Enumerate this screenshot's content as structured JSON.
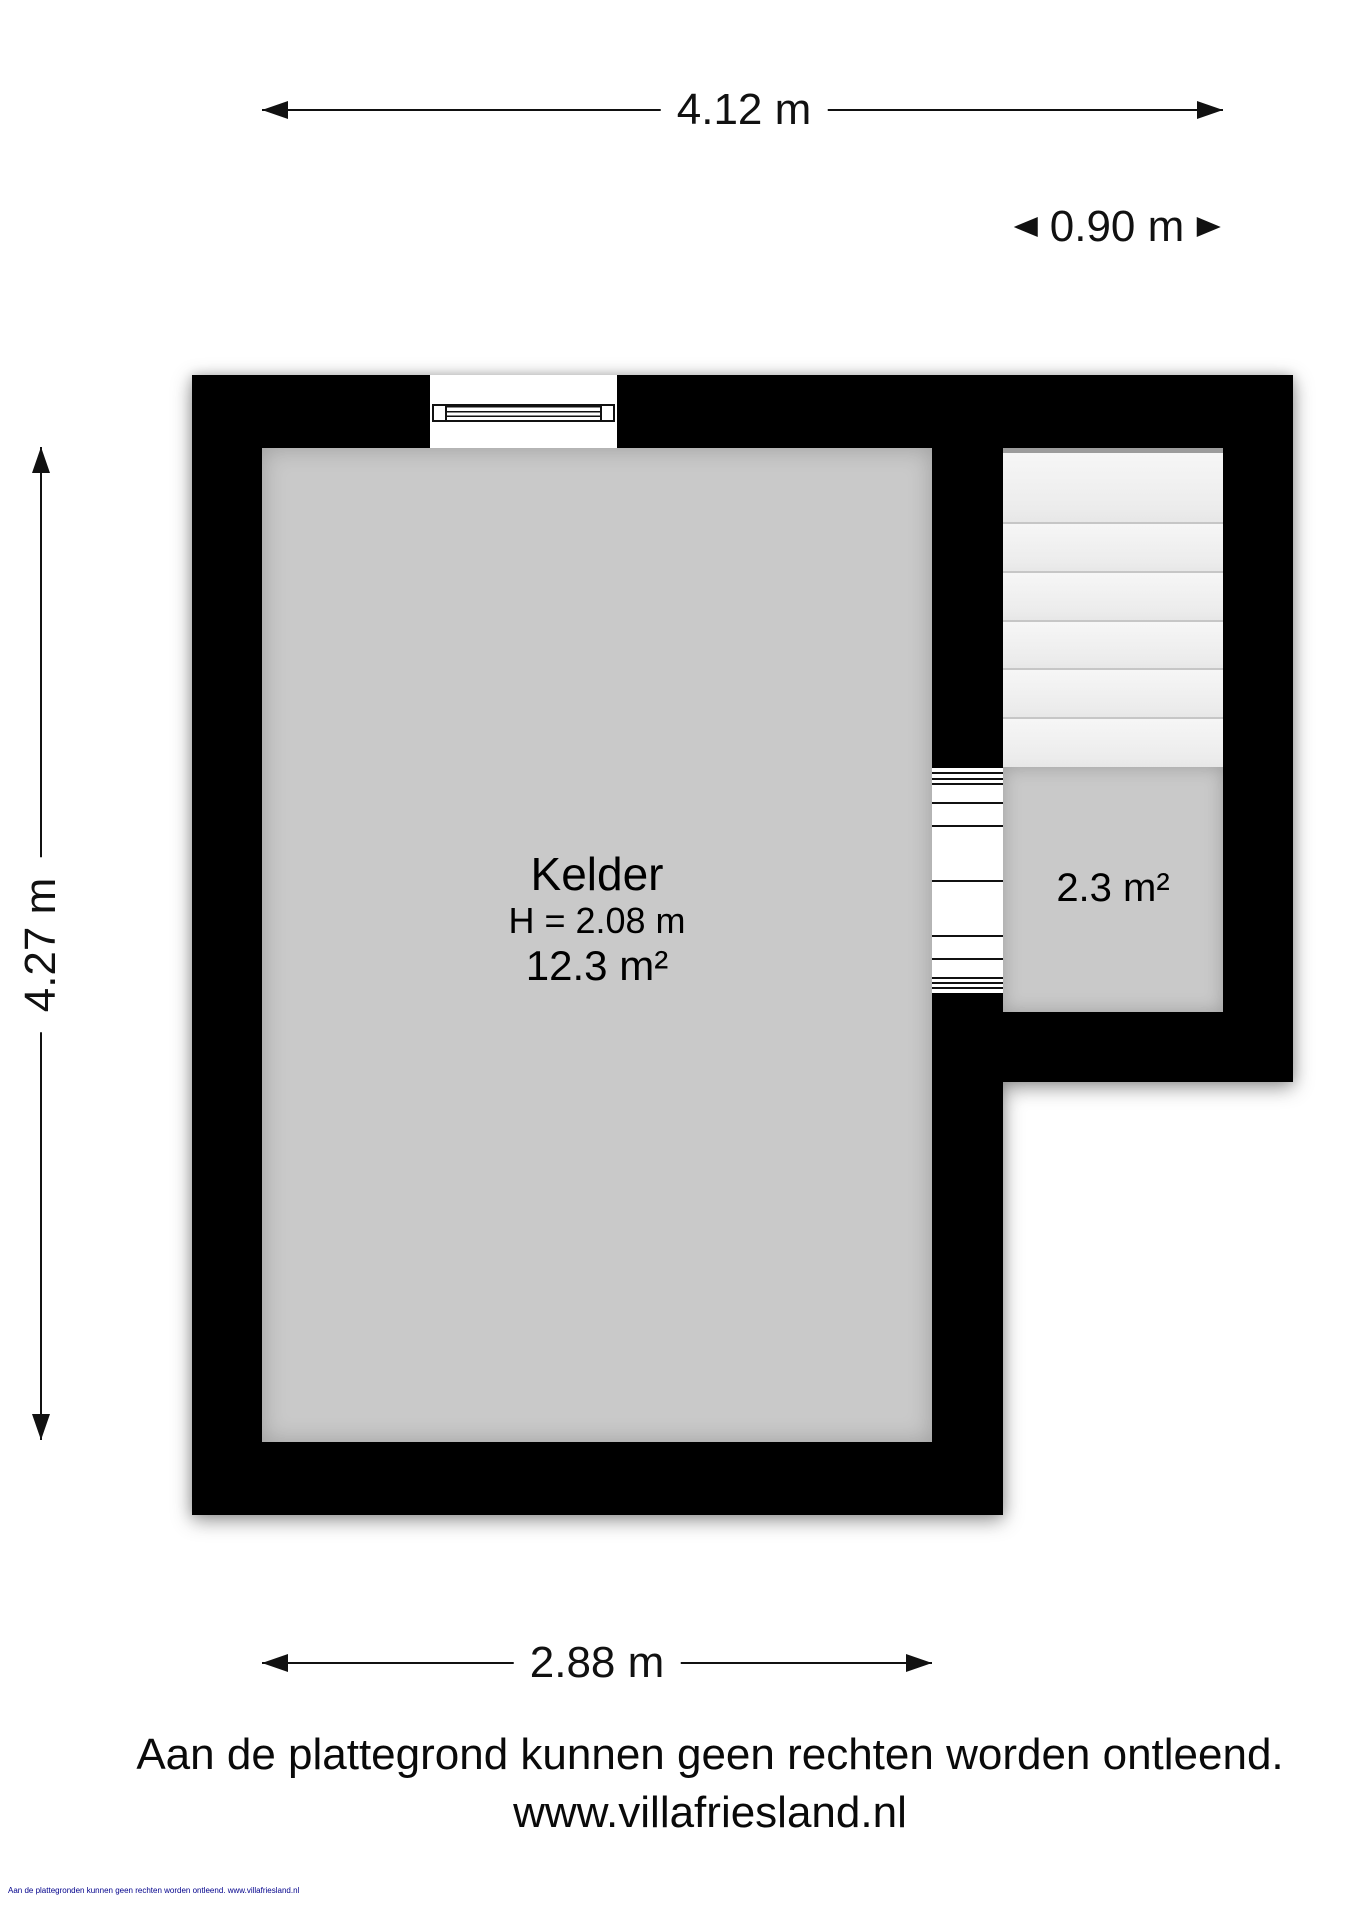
{
  "dimensions": {
    "top_width": "4.12 m",
    "stairs_width": "0.90 m",
    "left_height": "4.27 m",
    "bottom_width": "2.88 m"
  },
  "rooms": {
    "kelder": {
      "name": "Kelder",
      "ceiling_height": "H = 2.08 m",
      "area": "12.3 m²"
    },
    "stairwell": {
      "area": "2.3 m²"
    }
  },
  "staircase": {
    "top_strip_px": 5,
    "tread_heights_px": [
      71,
      49,
      49,
      48,
      49,
      48
    ]
  },
  "door_steps": {
    "height_px": 225,
    "line_offsets_px": [
      4,
      10,
      15,
      34,
      57,
      112,
      167,
      190,
      209,
      214,
      219
    ]
  },
  "footer": {
    "disclaimer": "Aan de plattegrond kunnen geen rechten worden ontleend.",
    "website": "www.villafriesland.nl"
  },
  "fine_print": {
    "text": "Aan de plattegronden kunnen geen rechten worden ontleend. www.villafriesland.nl"
  },
  "colors": {
    "wall": "#000000",
    "room_fill": "#c9c9c9",
    "stairs_fill": "#f0f0f0",
    "tread_line": "#c6c6c6",
    "stairs_top_strip": "#9c9c9c",
    "ink": "#111111",
    "fine_print": "#00008b"
  }
}
